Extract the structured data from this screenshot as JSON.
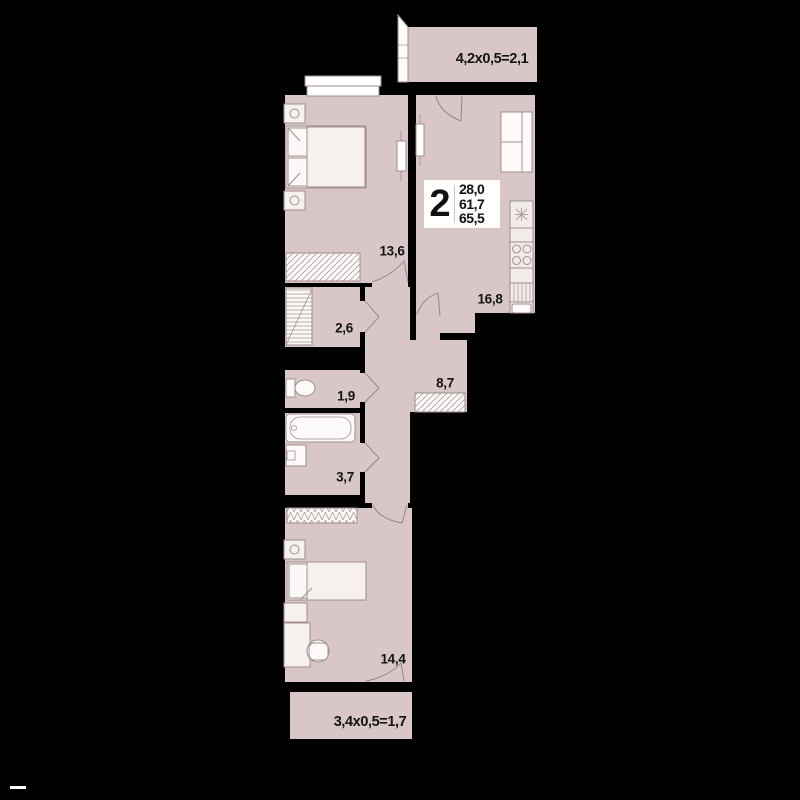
{
  "plan": {
    "title": "apartment-floor-plan",
    "background_color": "#000000",
    "floor_color": "#d9c6c6",
    "wall_color": "#000000",
    "fixture_fill": "#f6f1ef",
    "fixture_outline": "#a08f8d",
    "info_badge": {
      "room_count": "2",
      "living_area": "28,0",
      "apartment_area": "61,7",
      "total_area": "65,5"
    },
    "room_labels": {
      "bedroom": "13,6",
      "kitchen_living": "16,8",
      "storage": "2,6",
      "wc": "1,9",
      "hallway": "8,7",
      "bathroom": "3,7",
      "bedroom2": "14,4",
      "loggia_top": "4,2x0,5=2,1",
      "loggia_bottom": "3,4x0,5=1,7"
    }
  }
}
